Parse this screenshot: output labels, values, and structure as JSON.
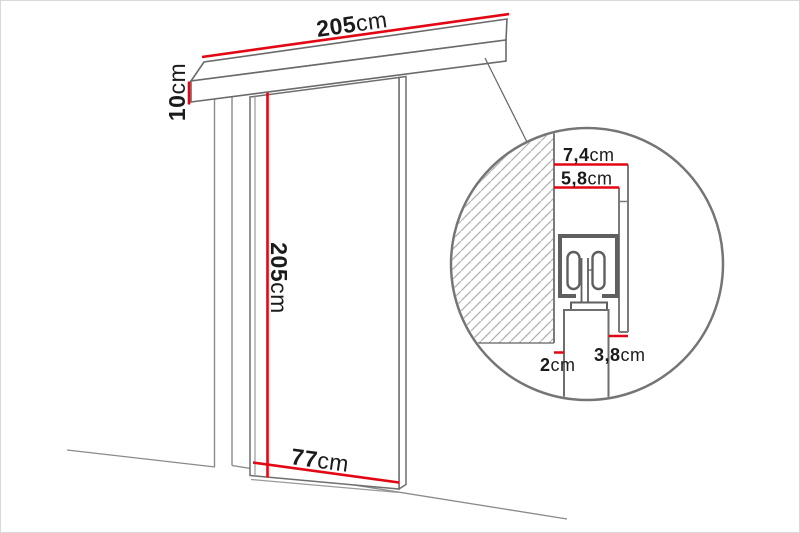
{
  "diagram": {
    "title": "sliding-door-dimension-diagram",
    "colors": {
      "dimension_red": "#e30613",
      "line_gray": "#7b7b7b",
      "dark_gray": "#5f5f5f",
      "text_black": "#1b1b1b"
    },
    "main_view": {
      "rail_length": {
        "value": "205",
        "unit": "cm"
      },
      "rail_height": {
        "value": "10",
        "unit": "cm"
      },
      "door_height": {
        "value": "205",
        "unit": "cm"
      },
      "door_width": {
        "value": "77",
        "unit": "cm"
      }
    },
    "detail_view": {
      "total_depth": {
        "value": "7,4",
        "unit": "cm"
      },
      "track_depth": {
        "value": "5,8",
        "unit": "cm"
      },
      "panel_offset": {
        "value": "3,8",
        "unit": "cm"
      },
      "wall_gap": {
        "value": "2",
        "unit": "cm"
      }
    }
  }
}
